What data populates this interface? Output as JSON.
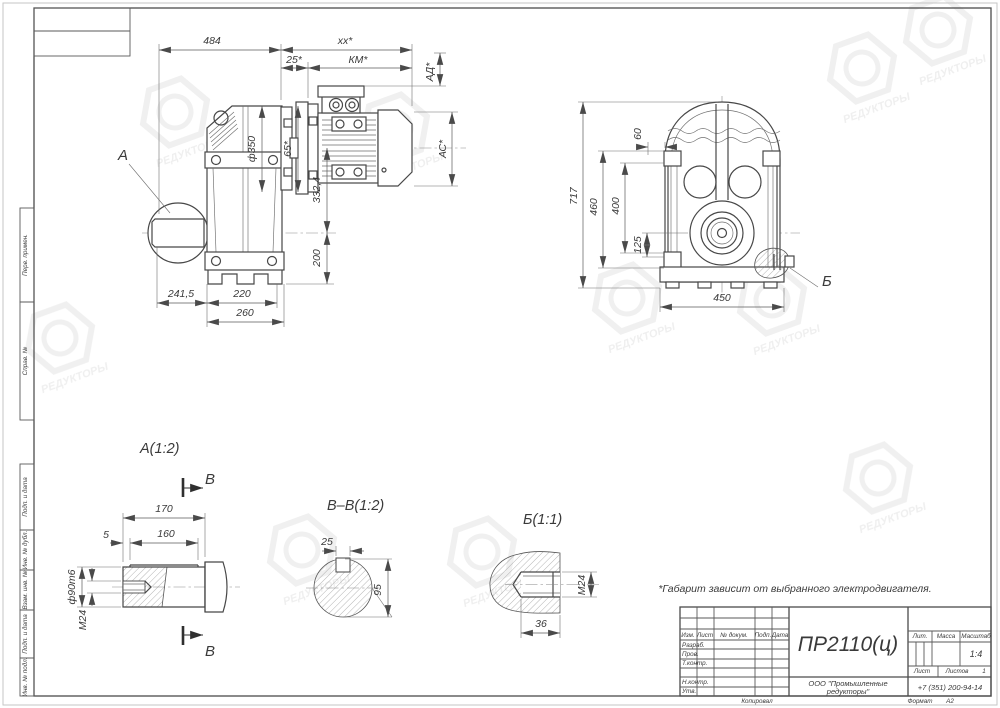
{
  "sheet": {
    "note": "*Габарит зависит от выбранного электродвигателя.",
    "watermark": "РЕДУКТОРЫ"
  },
  "margins": [
    "Перв. примен.",
    "Справ. №",
    "Подп. и дата",
    "Инв. № дубл.",
    "Взам. инв. №",
    "Подп. и дата",
    "Инв. № подл."
  ],
  "side": {
    "label": "А",
    "dims": {
      "d484": "484",
      "dxx": "хх*",
      "d25": "25*",
      "dkm": "КМ*",
      "dad": "АД*",
      "dac": "АС*",
      "df350": "ф350",
      "d65": "65*",
      "d3324": "332,4",
      "d200": "200",
      "d2415": "241,5",
      "d220": "220",
      "d260": "260"
    }
  },
  "front": {
    "label": "Б",
    "dims": {
      "d717": "717",
      "d460": "460",
      "d400": "400",
      "d125": "125",
      "d60": "60",
      "d450": "450"
    }
  },
  "sections": {
    "a": {
      "title": "А(1:2)",
      "cut_label": "В",
      "dims": {
        "d170": "170",
        "d160": "160",
        "d5": "5",
        "d90": "ф90m6",
        "dm24": "М24"
      }
    },
    "bb": {
      "title": "В–В(1:2)",
      "dims": {
        "d25": "25",
        "d95": "95"
      }
    },
    "b": {
      "title": "Б(1:1)",
      "dims": {
        "d36": "36",
        "dm24": "М24"
      }
    }
  },
  "stamp": {
    "designation": "ПР2110(ц)",
    "org1": "ООО \"Промышленные",
    "org2": "редукторы\"",
    "phone": "+7 (351) 200-94-14",
    "lit": "Лит.",
    "mass": "Масса",
    "scale": "Масштаб",
    "scale_value": "1:4",
    "sheet": "Лист",
    "sheets": "Листов",
    "sheets_value": "1",
    "izm": "Изм.",
    "list": "Лист",
    "doc": "№ докум.",
    "podp": "Подп.",
    "date": "Дата",
    "rows": [
      "Разраб.",
      "Пров.",
      "Т.контр.",
      "Н.контр.",
      "Утв."
    ],
    "copied": "Копировал",
    "format": "Формат",
    "format_value": "А2"
  }
}
